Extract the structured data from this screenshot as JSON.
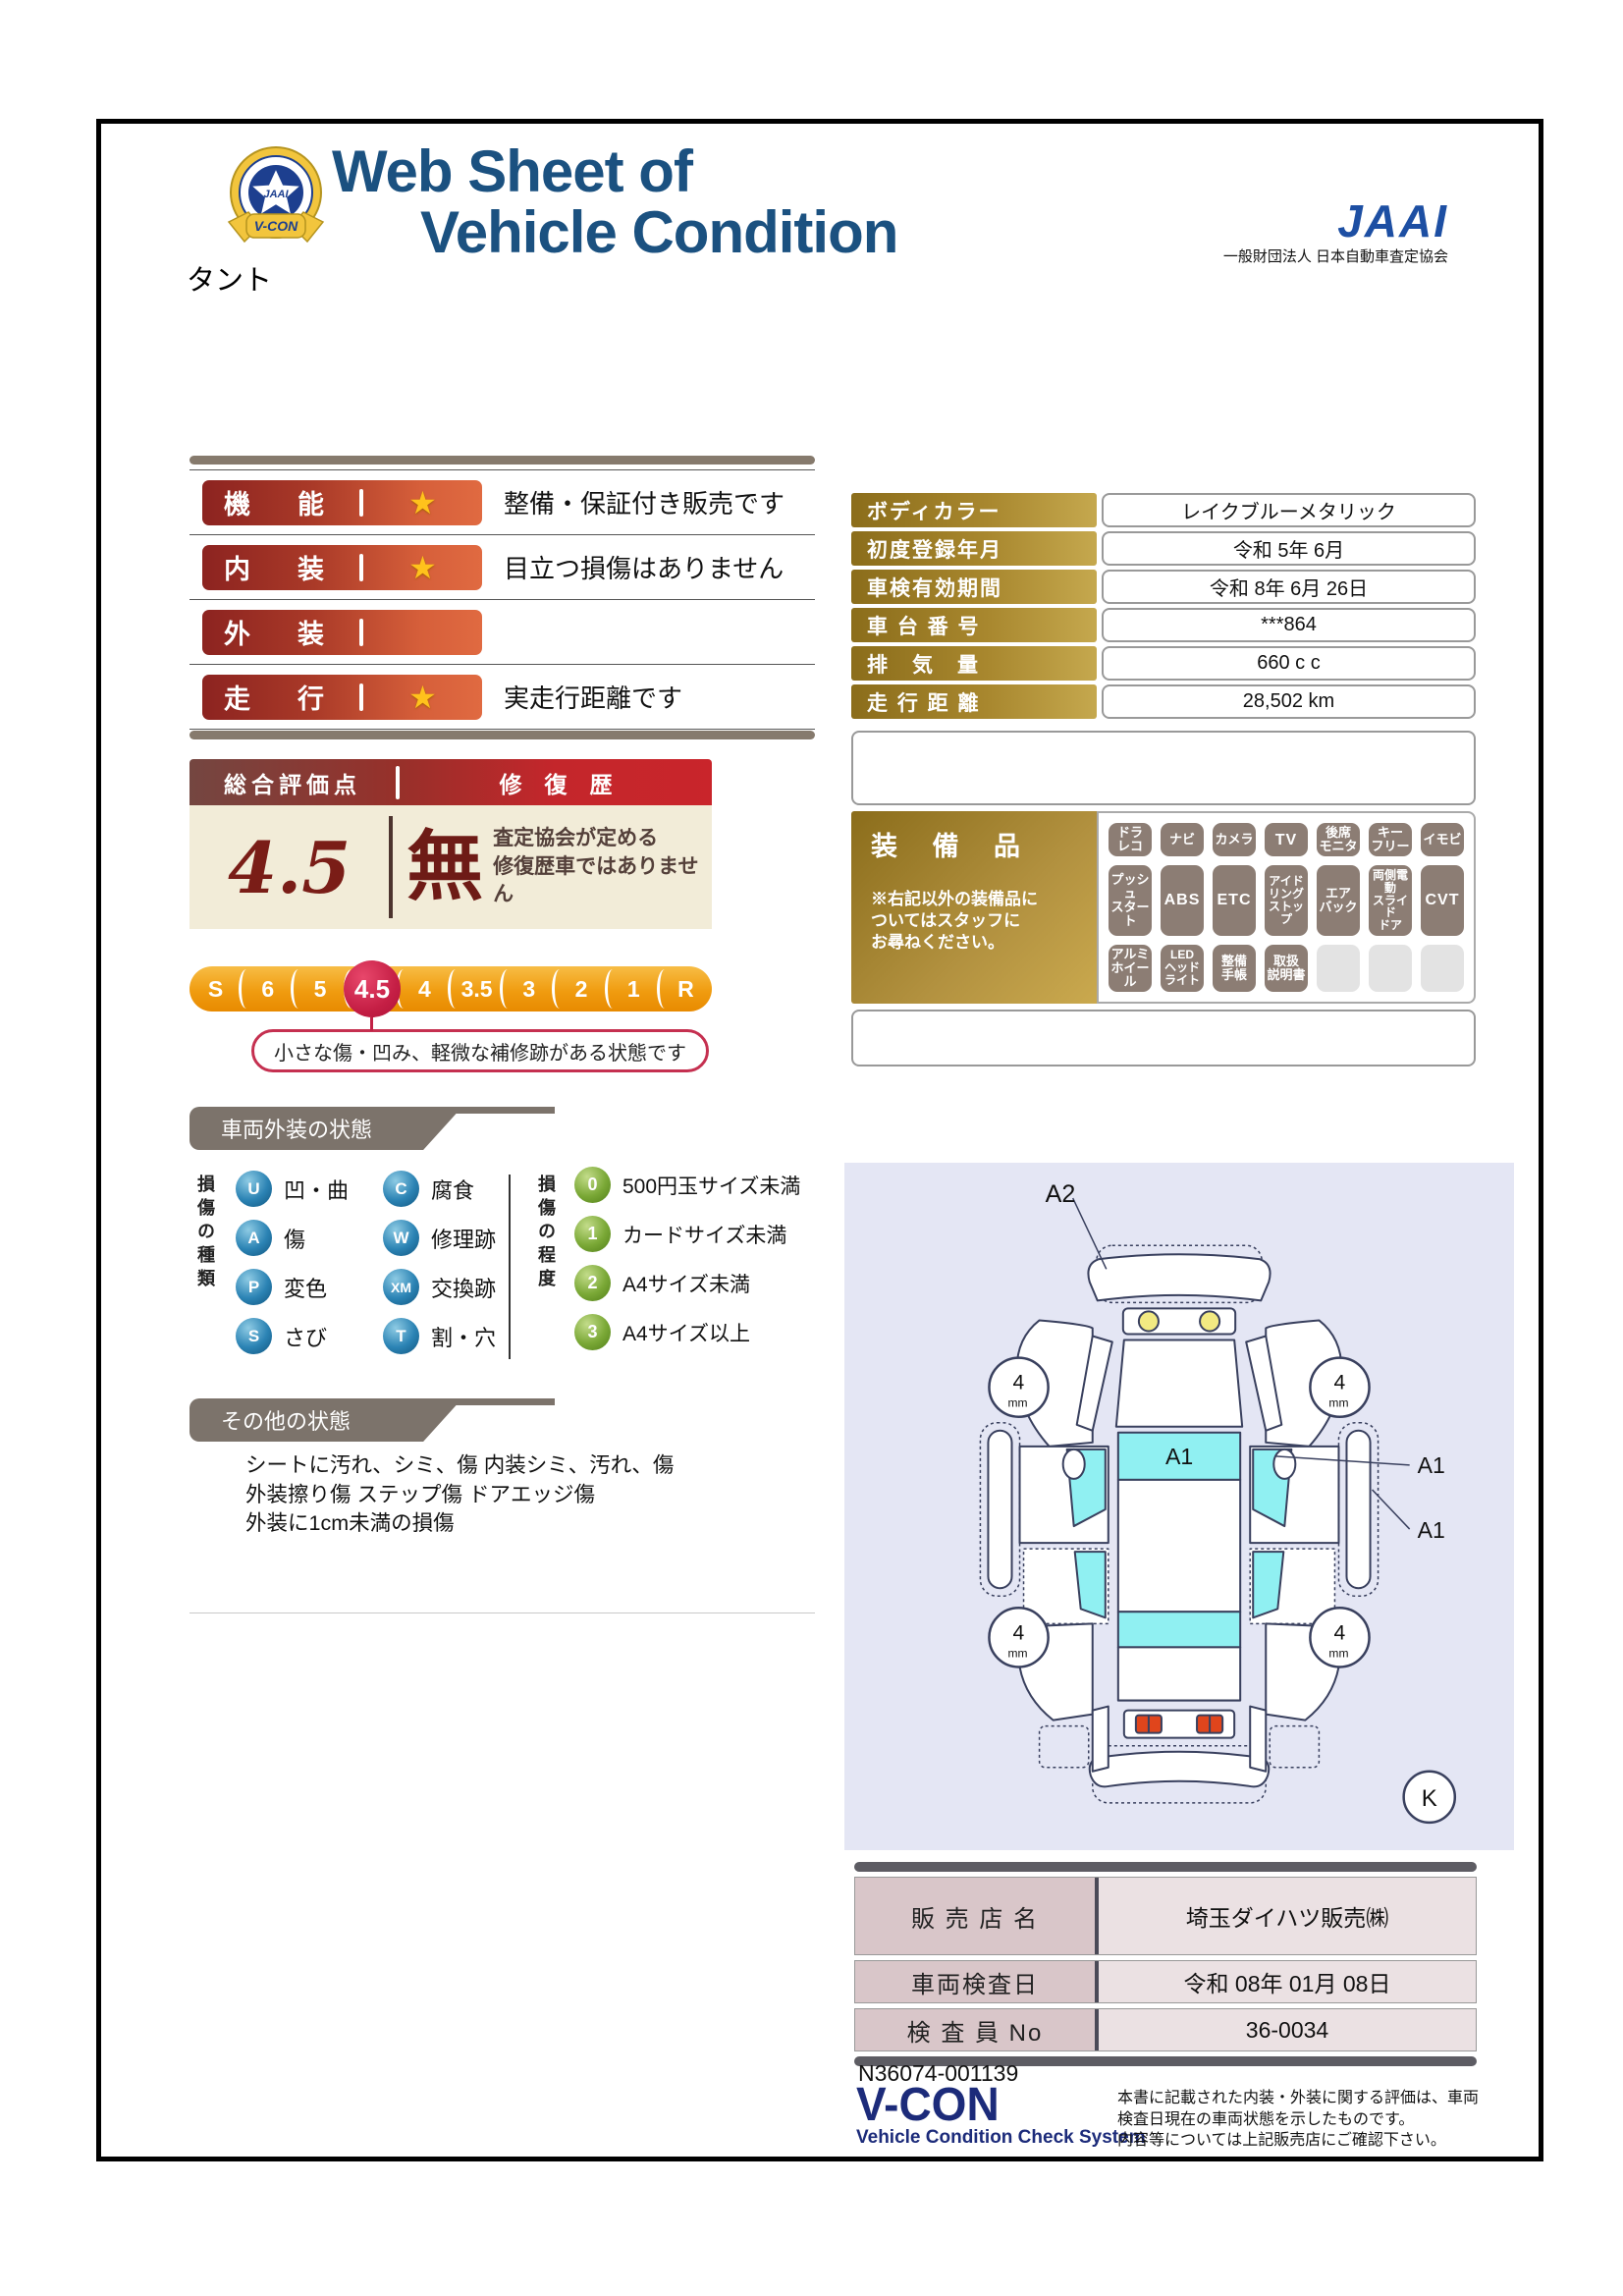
{
  "header": {
    "title_line1": "Web Sheet of",
    "title_line2": "Vehicle Condition",
    "jaai_logo": "JAAI",
    "jaai_org": "一般財団法人 日本自動車査定協会",
    "vcon_badge": "V-CON"
  },
  "vehicle_name": "タント",
  "ratings": {
    "star_icon": "★",
    "rows": [
      {
        "label": "機能",
        "starred": true,
        "desc": "整備・保証付き販売です"
      },
      {
        "label": "内装",
        "starred": true,
        "desc": "目立つ損傷はありません"
      },
      {
        "label": "外装",
        "starred": false,
        "desc": ""
      },
      {
        "label": "走行",
        "starred": true,
        "desc": "実走行距離です"
      }
    ]
  },
  "overall": {
    "header_left": "総合評価点",
    "header_right": "修　復　歴",
    "score": "4.5",
    "repair_mark": "無",
    "repair_note_line1": "査定協会が定める",
    "repair_note_line2": "修復歴車ではありません"
  },
  "scale": {
    "items": [
      "S",
      "6",
      "5",
      "4.5",
      "4",
      "3.5",
      "3",
      "2",
      "1",
      "R"
    ],
    "selected": "4.5",
    "callout": "小さな傷・凹み、軽微な補修跡がある状態です"
  },
  "details": {
    "rows": [
      {
        "label": "ボディカラー",
        "value": "レイクブルーメタリック"
      },
      {
        "label": "初度登録年月",
        "value": "令和 5年 6月"
      },
      {
        "label": "車検有効期間",
        "value": "令和 8年 6月 26日"
      },
      {
        "label": "車 台 番 号",
        "value": "***864"
      },
      {
        "label": "排　気　量",
        "value": "660 c c"
      },
      {
        "label": "走 行 距 離",
        "value": "28,502 km"
      }
    ]
  },
  "equipment": {
    "title": "装 備 品",
    "note": "※右記以外の装備品に\nついてはスタッフに\nお尋ねください。",
    "badges": [
      {
        "label": "ドラ\nレコ",
        "active": true
      },
      {
        "label": "ナビ",
        "active": true
      },
      {
        "label": "カメラ",
        "active": true
      },
      {
        "label": "TV",
        "active": true
      },
      {
        "label": "後席\nモニタ",
        "active": true
      },
      {
        "label": "キー\nフリー",
        "active": true
      },
      {
        "label": "イモビ",
        "active": true
      },
      {
        "label": "プッシュ\nスタート",
        "active": true
      },
      {
        "label": "ABS",
        "active": true
      },
      {
        "label": "ETC",
        "active": true
      },
      {
        "label": "アイド\nリング\nストップ",
        "active": true
      },
      {
        "label": "エア\nバック",
        "active": true
      },
      {
        "label": "両側電動\nスライド\nドア",
        "active": true
      },
      {
        "label": "CVT",
        "active": true
      },
      {
        "label": "アルミ\nホイール",
        "active": true
      },
      {
        "label": "LED\nヘッド\nライト",
        "active": true
      },
      {
        "label": "整備\n手帳",
        "active": true
      },
      {
        "label": "取扱\n説明書",
        "active": true
      },
      {
        "label": "",
        "active": false
      },
      {
        "label": "",
        "active": false
      },
      {
        "label": "",
        "active": false
      }
    ]
  },
  "exterior": {
    "banner": "車両外装の状態",
    "type_axis": "損傷の種類",
    "types": [
      {
        "code": "U",
        "label": "凹・曲"
      },
      {
        "code": "C",
        "label": "腐食"
      },
      {
        "code": "A",
        "label": "傷"
      },
      {
        "code": "W",
        "label": "修理跡"
      },
      {
        "code": "P",
        "label": "変色"
      },
      {
        "code": "XM",
        "label": "交換跡"
      },
      {
        "code": "S",
        "label": "さび"
      },
      {
        "code": "T",
        "label": "割・穴"
      }
    ],
    "degree_axis": "損傷の程度",
    "degrees": [
      {
        "code": "0",
        "label": "500円玉サイズ未満"
      },
      {
        "code": "1",
        "label": "カードサイズ未満"
      },
      {
        "code": "2",
        "label": "A4サイズ未満"
      },
      {
        "code": "3",
        "label": "A4サイズ以上"
      }
    ]
  },
  "other": {
    "banner": "その他の状態",
    "lines": [
      "シートに汚れ、シミ、傷 内装シミ、汚れ、傷",
      "外装擦り傷 ステップ傷 ドアエッジ傷",
      "外装に1cm未満の損傷"
    ]
  },
  "diagram": {
    "a2": "A2",
    "a1": "A1",
    "k": "K",
    "tread_value": "4",
    "tread_unit": "mm"
  },
  "dealer": {
    "rows": [
      {
        "label": "販 売 店 名",
        "value": "埼玉ダイハツ販売㈱"
      },
      {
        "label": "車両検査日",
        "value": "令和 08年 01月 08日"
      },
      {
        "label": "検 査 員 No",
        "value": "36-0034"
      }
    ]
  },
  "footer": {
    "doc_number": "N36074-001139",
    "vcon_logo": "V-CON",
    "vcon_sub": "Vehicle Condition Check System",
    "disclaimer_lines": [
      "本書に記載された内装・外装に関する評価は、車両",
      "検査日現在の車両状態を示したものです。",
      "内容等については上記販売店にご確認下さい。"
    ]
  },
  "colors": {
    "accent_red": "#c4262b",
    "bar_red_dark": "#8c2320",
    "bar_red_light": "#e06a41",
    "gold_label": "#a8872e",
    "crimson_highlight": "#c51f45",
    "title_navy": "#1b5180",
    "jaai_blue": "#1d4fa3",
    "vcon_navy": "#1c2b7a",
    "cyan_glass": "#90f0f2",
    "cream": "#f2ecd8",
    "banner_gray": "#7c736b",
    "badge_gray": "#8c7d74",
    "diagram_bg": "#e4e6f4"
  }
}
